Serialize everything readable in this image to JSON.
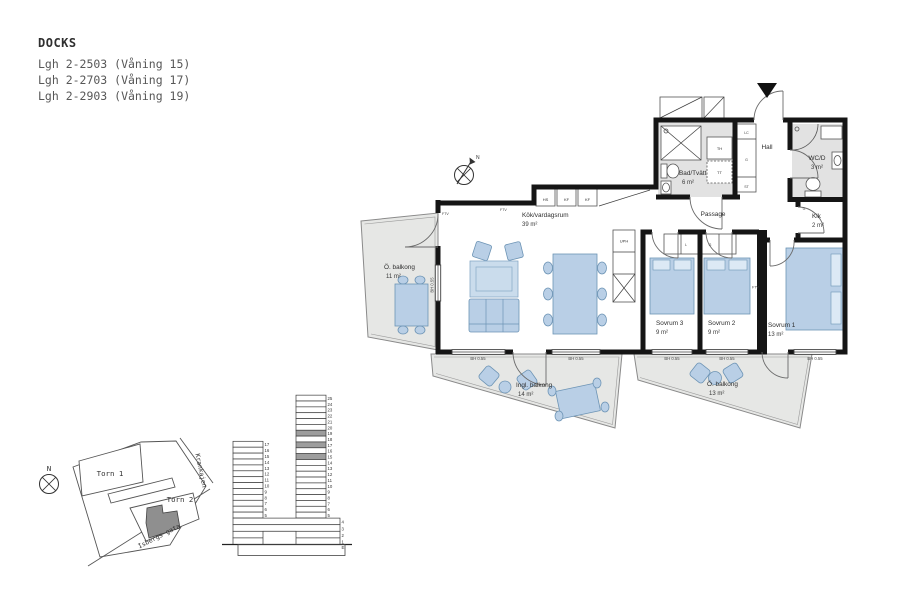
{
  "header": {
    "project": "DOCKS",
    "units": [
      "Lgh 2-2503 (Våning 15)",
      "Lgh 2-2703 (Våning 17)",
      "Lgh 2-2903 (Våning 19)"
    ]
  },
  "floorplan": {
    "rooms": {
      "livingroom": {
        "name": "Kök/vardagsrum",
        "area": "39 m²"
      },
      "bath": {
        "name": "Bad/Tvätt",
        "area": "6 m²"
      },
      "hall": {
        "name": "Hall"
      },
      "wcd": {
        "name": "WC/D",
        "area": "3 m²"
      },
      "passage": {
        "name": "Passage"
      },
      "klk": {
        "name": "Klk",
        "area": "2 m²"
      },
      "sovrum1": {
        "name": "Sovrum 1",
        "area": "13 m²"
      },
      "sovrum2": {
        "name": "Sovrum 2",
        "area": "9 m²"
      },
      "sovrum3": {
        "name": "Sovrum 3",
        "area": "9 m²"
      },
      "balcony_west": {
        "name": "Ö. balkong",
        "area": "11 m²"
      },
      "balcony_glazed": {
        "name": "Ingl. balkong",
        "area": "14 m²"
      },
      "balcony_east": {
        "name": "Ö. balkong",
        "area": "13 m²"
      }
    },
    "fixtures": {
      "hs": "HS",
      "kf": "KF",
      "uph": "UPH",
      "ftv": "FTV",
      "g": "G",
      "l": "L",
      "lc": "LC",
      "st": "ST",
      "th": "TH",
      "tt": "TT"
    },
    "window_label": "BH 0.55",
    "north_label": "N"
  },
  "site_map": {
    "north_label": "N",
    "buildings": [
      "Torn 1",
      "Torn 2"
    ],
    "streets": [
      "Krankajen",
      "Isbergs gata"
    ],
    "highlight_color": "#8f8f8f"
  },
  "elevation": {
    "left_tower_floors": [
      17,
      16,
      15,
      14,
      13,
      12,
      11,
      10,
      9,
      8,
      7,
      6,
      5
    ],
    "right_tower_floors": [
      25,
      24,
      23,
      22,
      21,
      20,
      19,
      18,
      17,
      16,
      15,
      14,
      13,
      12,
      11,
      10,
      9,
      8,
      7,
      6,
      5,
      4,
      3,
      2,
      1
    ],
    "highlighted_floors": [
      19,
      17,
      15
    ],
    "highlight_color": "#9d9d9d",
    "ground_label": "E"
  }
}
